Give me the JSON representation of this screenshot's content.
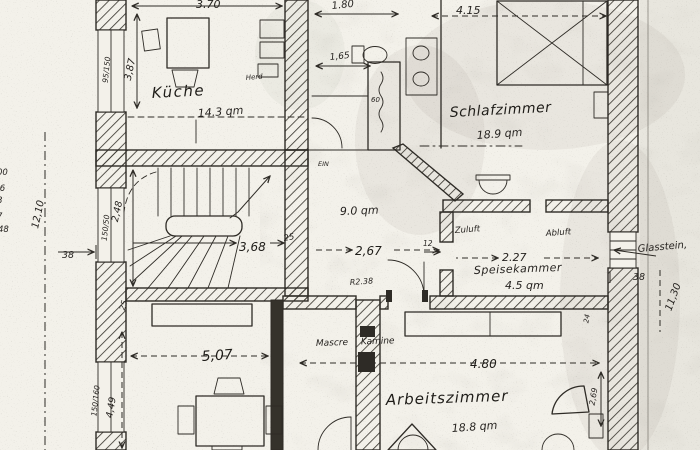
{
  "document": {
    "kind": "scanned hand-drawn floor plan",
    "language": "de"
  },
  "colors": {
    "paper": "#f3f1ea",
    "ink": "#2e2b26"
  },
  "rooms": {
    "kueche": {
      "label": "Küche",
      "area": "14.3 qm"
    },
    "schlafzimmer": {
      "label": "Schlafzimmer",
      "area": "18.9 qm"
    },
    "flur": {
      "area": "9.0 qm"
    },
    "speisekammer": {
      "label": "Speisekammer",
      "area": "4.5 qm"
    },
    "arbeitszimmer": {
      "label": "Arbeitszimmer",
      "area": "18.8 qm"
    }
  },
  "dimensions": {
    "kueche_width": "3.70",
    "kueche_depth": "3,87",
    "bad_width": "1.80",
    "bad_inner": "1,65",
    "schlafzimmer_width": "4.15",
    "treppe_width": "3,68",
    "treppe_depth": "2,48",
    "flur_width": "2,67",
    "speisekammer_width": "2.27",
    "wohnraum_width": "5,07",
    "wohnraum_depth": "4,49",
    "arbeitszimmer_width": "4.80",
    "arbeitszimmer_depth": "2,69",
    "gesamt_links": "12,10",
    "gesamt_rechts": "11,30",
    "wand_links": "38",
    "wand_rechts": "38",
    "wand_treppe": "25",
    "wand_unten": "25",
    "wand_stub": "12",
    "wand_klein": "24",
    "schacht": "60",
    "tuer": "R2.38"
  },
  "windows": {
    "kueche": "95/150",
    "treppe": "150/50",
    "wohnraum": "150/160"
  },
  "annotations": {
    "zuluft": "Zuluft",
    "abluft": "Abluft",
    "glasstein": "Glasstein,",
    "kamine": "Mascre Kamine",
    "ein": "EIN",
    "herd": "Herd"
  },
  "margin_marks": {
    "m1": "00",
    "m2": ",6",
    "m3": "8",
    "m4": "7",
    "m5": "48"
  }
}
